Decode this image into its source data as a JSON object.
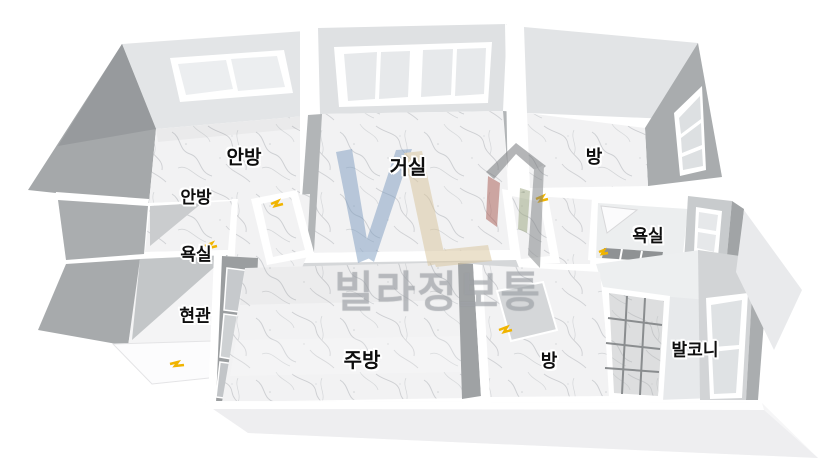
{
  "view": {
    "background": "#ffffff",
    "render_style": "3d-dollhouse-floorplan"
  },
  "rooms": [
    {
      "label": "안방"
    },
    {
      "label": "거실"
    },
    {
      "label": "방"
    },
    {
      "label_line1": "안방",
      "label_line2": "욕실"
    },
    {
      "label": "욕실"
    },
    {
      "label": "현관"
    },
    {
      "label": "주방"
    },
    {
      "label": "방"
    },
    {
      "label": "발코니"
    }
  ],
  "watermark": {
    "text": "빌라정보통",
    "logo_letters": "VL",
    "logo_icon": "house-icon",
    "colors": {
      "letter_v": "#7d9cc0",
      "letter_l": "#d8c49a",
      "house_roof": "#6b6e71",
      "house_red": "#a85a52",
      "house_green": "#9aa57f",
      "text": "#a6aaaf"
    }
  },
  "door_markers": {
    "count": 6,
    "color": "#f0b400"
  },
  "palette": {
    "wall_inner": "#e2e4e6",
    "wall_side": "#c4c7c9",
    "wall_outer": "#a3a6a8",
    "wall_top": "#ffffff",
    "floor_marble_base": "#f2f2f3",
    "floor_vein": "#b5b8bc",
    "bath_tile_dark": "#8f9294",
    "window_pane": "#e7e9eb",
    "label_text": "#0e0e0e",
    "label_halo": "#ffffff"
  }
}
